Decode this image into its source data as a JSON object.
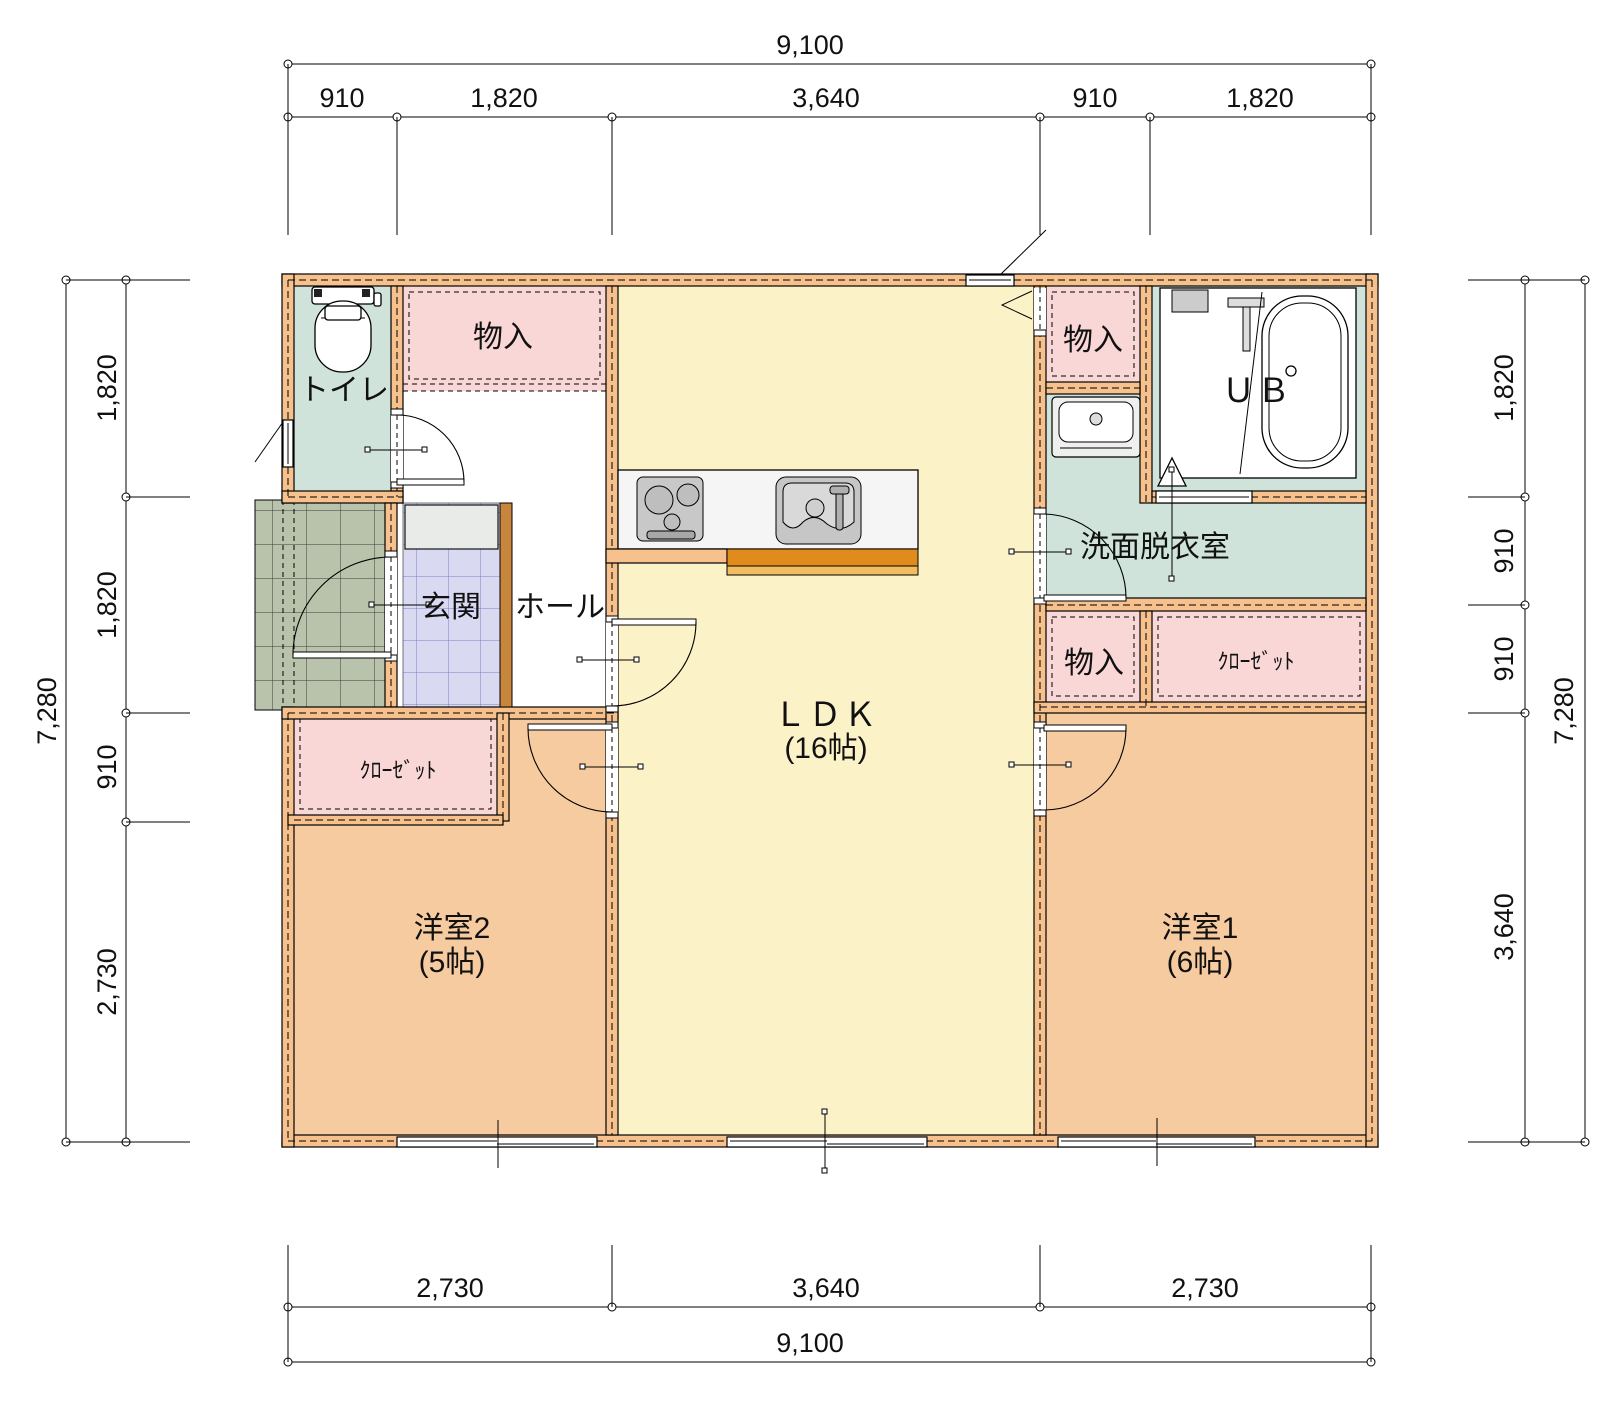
{
  "rooms": {
    "toilet": {
      "label": "トイレ"
    },
    "storage_top_left": {
      "label": "物入"
    },
    "entrance": {
      "label": "玄関"
    },
    "hall": {
      "label": "ホール"
    },
    "ldk": {
      "label": "ＬＤＫ",
      "size": "(16帖)"
    },
    "storage_top_right": {
      "label": "物入"
    },
    "unit_bath": {
      "label": "ＵＢ"
    },
    "washroom": {
      "label": "洗面脱衣室"
    },
    "storage_mid_right": {
      "label": "物入"
    },
    "closet_right": {
      "label": "ｸﾛｰｾﾞｯﾄ"
    },
    "closet_left": {
      "label": "ｸﾛｰｾﾞｯﾄ"
    },
    "bedroom2": {
      "label": "洋室2",
      "size": "(5帖)"
    },
    "bedroom1": {
      "label": "洋室1",
      "size": "(6帖)"
    }
  },
  "dimensions": {
    "top": {
      "total": "9,100",
      "segments": [
        "910",
        "1,820",
        "3,640",
        "910",
        "1,820"
      ]
    },
    "bottom": {
      "total": "9,100",
      "segments": [
        "2,730",
        "3,640",
        "2,730"
      ]
    },
    "left": {
      "total": "7,280",
      "segments": [
        "1,820",
        "1,820",
        "910",
        "2,730"
      ]
    },
    "right": {
      "total": "7,280",
      "segments": [
        "1,820",
        "910",
        "910",
        "3,640"
      ]
    }
  },
  "colors": {
    "wall": "#F6C18D",
    "room_teal": "#CFE3DA",
    "room_pink": "#F9D7D7",
    "room_yellow": "#FBF2C7",
    "room_orange": "#F7CBA0",
    "entrance_tile": "#D9DAF2",
    "porch_tile": "#B9C3AB",
    "entrance_step": "#C8863C",
    "kitchen_counter_bar": "#E08B1B",
    "line": "#000000"
  }
}
